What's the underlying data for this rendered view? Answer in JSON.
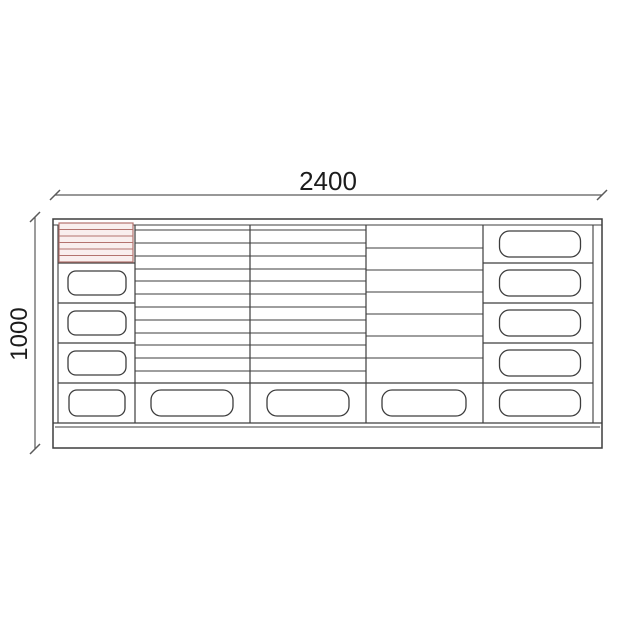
{
  "page": {
    "background": "#ffffff"
  },
  "diagram": {
    "kind": "technical-drawing",
    "subject": "cabinet-front-elevation",
    "labels": {
      "width": "2400",
      "height": "1000"
    },
    "colors": {
      "outline": "#3d3d3d",
      "dim": "#5a5a5a",
      "label": "#1c1c1c",
      "hatch_stroke": "#b3736e",
      "hatch_fill": "#f9efee"
    },
    "geometry": {
      "outer": [
        53,
        219,
        602,
        448
      ],
      "inner_top_y": 225,
      "side_walls_x": [
        58,
        593
      ],
      "dividers_x": [
        135,
        250,
        366,
        483
      ],
      "divider_top_y": 225,
      "bottom_row_top_y": 383,
      "drawer_bottom_y": 423,
      "plinth_top_y": 427,
      "stack_divider_y": [
        263,
        303,
        343
      ],
      "stack_segments": [
        [
          58,
          135
        ],
        [
          483,
          593
        ]
      ],
      "shelf_lines": [
        {
          "x1": 135,
          "x2": 366,
          "ys": [
            230,
            243,
            256,
            269,
            281,
            294,
            307,
            320,
            333,
            345,
            358,
            371
          ]
        },
        {
          "x1": 366,
          "x2": 483,
          "ys": [
            248,
            270,
            292,
            314,
            336,
            358
          ]
        }
      ],
      "hatch": {
        "x": 59,
        "y": 223,
        "w": 74,
        "h": 39,
        "lines": 5
      },
      "handles": [
        {
          "cx": 97,
          "cy": 283,
          "w": 58,
          "h": 24,
          "r": 8
        },
        {
          "cx": 97,
          "cy": 323,
          "w": 58,
          "h": 24,
          "r": 8
        },
        {
          "cx": 97,
          "cy": 363,
          "w": 58,
          "h": 24,
          "r": 8
        },
        {
          "cx": 97,
          "cy": 403,
          "w": 56,
          "h": 26,
          "r": 8
        },
        {
          "cx": 540,
          "cy": 244,
          "w": 81,
          "h": 26,
          "r": 10
        },
        {
          "cx": 540,
          "cy": 283,
          "w": 81,
          "h": 26,
          "r": 10
        },
        {
          "cx": 540,
          "cy": 323,
          "w": 81,
          "h": 26,
          "r": 10
        },
        {
          "cx": 540,
          "cy": 363,
          "w": 81,
          "h": 26,
          "r": 10
        },
        {
          "cx": 540,
          "cy": 403,
          "w": 81,
          "h": 26,
          "r": 10
        },
        {
          "cx": 192,
          "cy": 403,
          "w": 82,
          "h": 26,
          "r": 10
        },
        {
          "cx": 308,
          "cy": 403,
          "w": 82,
          "h": 26,
          "r": 10
        },
        {
          "cx": 424,
          "cy": 403,
          "w": 84,
          "h": 26,
          "r": 10
        }
      ],
      "dim_h": {
        "y": 195,
        "x1": 55,
        "x2": 602,
        "label_x": 328,
        "label_y": 190,
        "font": 26
      },
      "dim_v": {
        "x": 35,
        "y1": 217,
        "y2": 449,
        "label_x": 27,
        "label_y": 334,
        "font": 24
      }
    }
  }
}
